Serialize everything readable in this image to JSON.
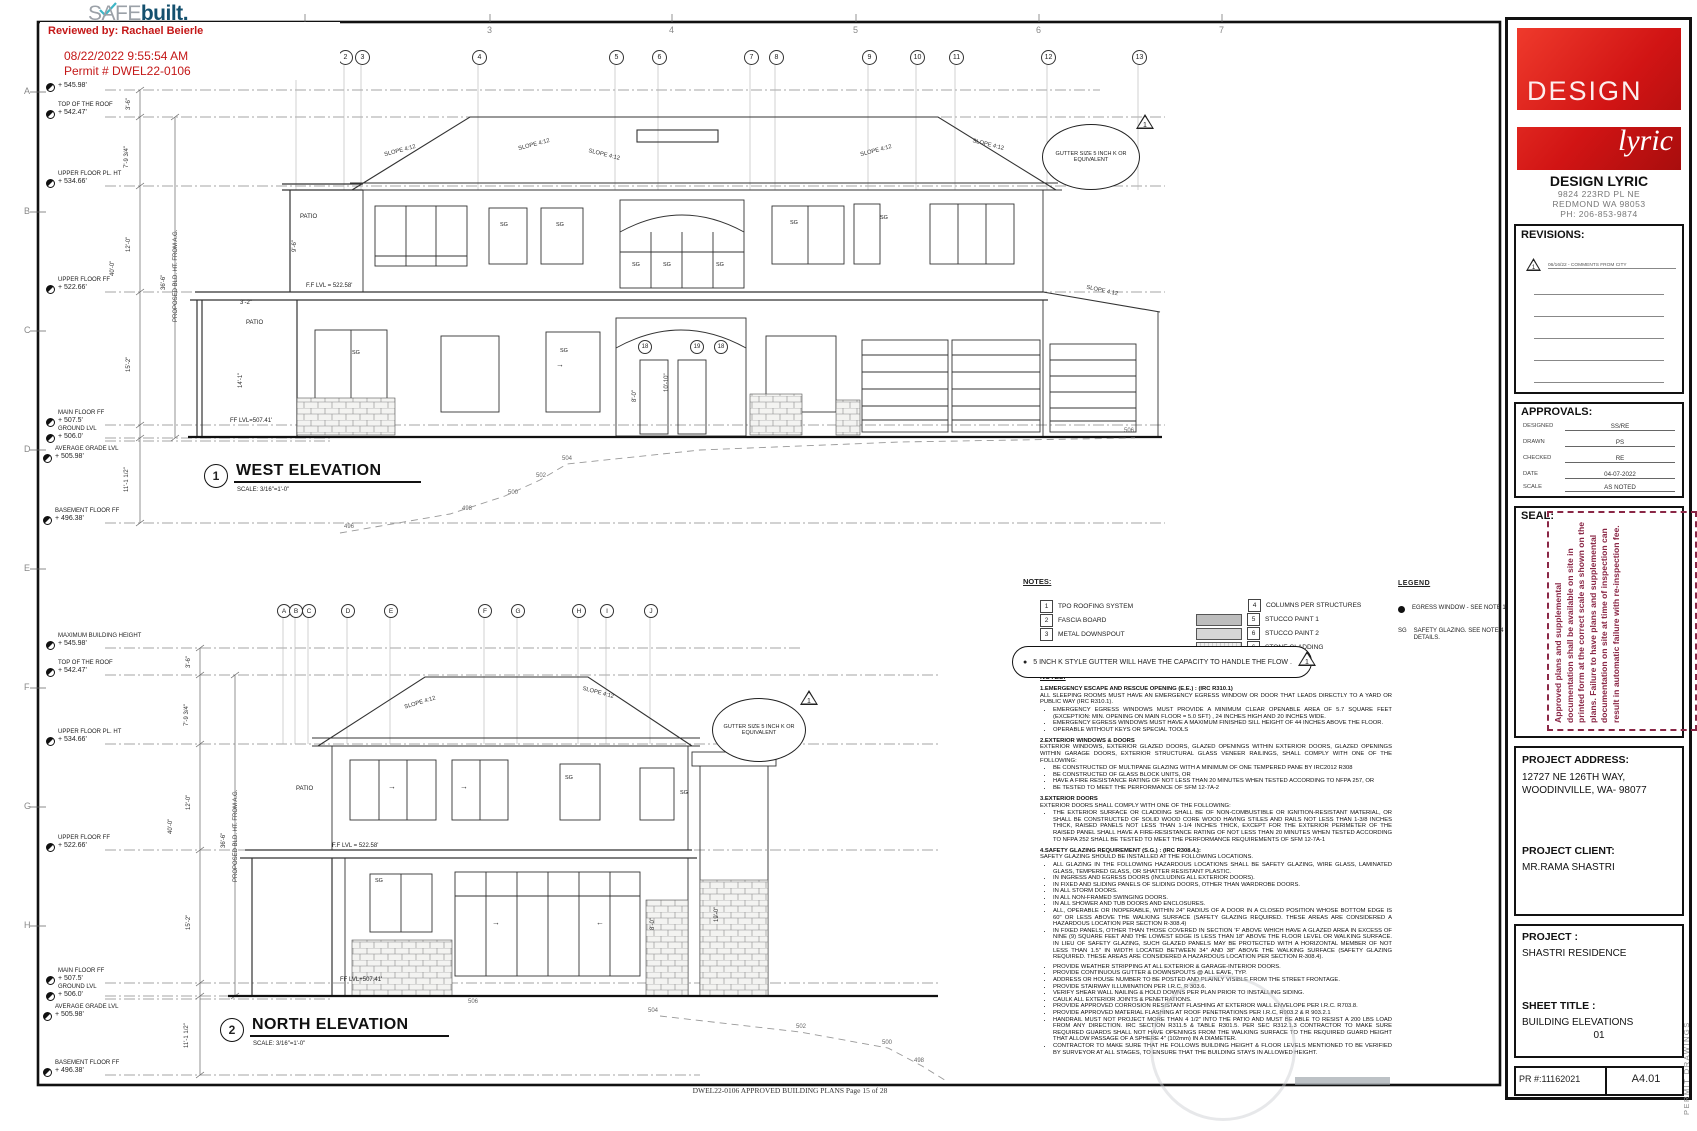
{
  "sym": {
    "slope": "SLOPE 4:12",
    "sg": "SG",
    "bullet": "●",
    "arrow_r": "→",
    "arrow_l": "←"
  },
  "safebuilt": {
    "safe": "SAFE",
    "built": "built",
    "dot": "."
  },
  "review_stamp": {
    "reviewed_by": "Reviewed by: Rachael Beierle",
    "datetime": "08/22/2022 9:55:54 AM",
    "permit": "Permit # DWEL22-0106"
  },
  "grid": {
    "top": [
      "2",
      "3",
      "4",
      "5",
      "6",
      "7"
    ],
    "left": [
      "A",
      "B",
      "C",
      "D",
      "E",
      "F",
      "G",
      "H"
    ]
  },
  "levels": [
    {
      "label": "MAXIMUM BUILDING HEIGHT",
      "value": "+ 545.98'"
    },
    {
      "label": "TOP OF THE ROOF",
      "value": "+ 542.47'"
    },
    {
      "label": "UPPER FLOOR PL. HT",
      "value": "+ 534.66'"
    },
    {
      "label": "UPPER FLOOR FF",
      "value": "+ 522.66'"
    },
    {
      "label": "MAIN FLOOR FF",
      "value": "+ 507.5'"
    },
    {
      "label": "GROUND LVL",
      "value": "+ 506.0'"
    },
    {
      "label": "AVERAGE GRADE LVL",
      "value": "+ 505.98'"
    },
    {
      "label": "BASEMENT FLOOR FF",
      "value": "+ 496.38'"
    }
  ],
  "west": {
    "num": "1",
    "title": "WEST ELEVATION",
    "scale": "SCALE:   3/16\"=1'-0\"",
    "bubbles": [
      "1",
      "2",
      "3",
      "4",
      "5",
      "6",
      "7",
      "8",
      "9",
      "10",
      "11",
      "12",
      "13"
    ],
    "dims": [
      "3'-6\"",
      "7'-9 3/4\"",
      "12'-0\"",
      "15'-2\"",
      "11'-1 1/2\"",
      "40'-0\"",
      "36'-6\"",
      "PROPOSED BLD. HT. FROM A.G.",
      "14'-1\""
    ],
    "house_dims": [
      "10'-10\"",
      "8'-0\"",
      "3'-2\"",
      "9'-6\""
    ],
    "ann": {
      "patio": "PATIO",
      "ff_upper": "F.F LVL = 522.58'",
      "ff_main": "FF LVL=507.41'"
    },
    "win_bubbles": [
      "18",
      "19",
      "18"
    ],
    "contours": [
      "496",
      "498",
      "500",
      "502",
      "504",
      "506"
    ],
    "gutter_note": "GUTTER SIZE 5 INCH K OR EQUIVALENT",
    "gutter_tri": "1"
  },
  "north": {
    "num": "2",
    "title": "NORTH ELEVATION",
    "scale": "SCALE:   3/16\"=1'-0\"",
    "bubbles": [
      "A",
      "B",
      "C",
      "D",
      "E",
      "F",
      "G",
      "H",
      "I",
      "J"
    ],
    "dims": [
      "3'-6\"",
      "7'-9 3/4\"",
      "12'-0\"",
      "15'-2\"",
      "11'-1 1/2\"",
      "40'-0\"",
      "36'-6\"",
      "PROPOSED BLD. HT. FROM A.G.",
      "19'-0\"",
      "8'-0\""
    ],
    "ann": {
      "patio": "PATIO",
      "ff_upper": "F.F LVL = 522.58'",
      "ff_main": "FF LVL+507.41'"
    },
    "contours": [
      "504",
      "502",
      "500",
      "498",
      "506"
    ],
    "gutter_note": "GUTTER SIZE 5 INCH K OR EQUIVALENT",
    "gutter_tri": "1"
  },
  "notes_key": {
    "title": "NOTES:",
    "items": [
      {
        "num": "1",
        "text": "TPO ROOFING SYSTEM"
      },
      {
        "num": "2",
        "text": "FASCIA BOARD"
      },
      {
        "num": "3",
        "text": "METAL DOWNSPOUT"
      },
      {
        "num": "4",
        "text": "COLUMNS PER STRUCTURES"
      },
      {
        "num": "5",
        "text": "STUCCO PAINT 1"
      },
      {
        "num": "6",
        "text": "STUCCO PAINT 2"
      },
      {
        "num": "6",
        "text": "STONE CLADDING"
      }
    ]
  },
  "legend": {
    "title": "LEGEND",
    "egress_text": "EGRESS WINDOW - SEE NOTE 1.",
    "sg_sym": "SG",
    "sg_text": "SAFETY GLAZING. SEE NOTE 4 FOR DETAILS."
  },
  "cloud_note": {
    "text": "5 INCH K STYLE GUTTER WILL HAVE THE CAPACITY TO HANDLE THE FLOW .",
    "tri": "1"
  },
  "notes": {
    "title": "NOTES:",
    "s1": {
      "h": "1.EMERGENCY ESCAPE AND RESCUE OPENING (E.E.) : (IRC R310.1)",
      "b": "ALL SLEEPING ROOMS MUST HAVE AN EMERGENCY EGRESS WINDOW OR DOOR THAT LEADS DIRECTLY TO A YARD OR PUBLIC WAY (IRC R310.1).",
      "li": [
        "EMERGENCY EGRESS WINDOWS MUST PROVIDE A MINIMUM CLEAR OPENABLE AREA OF 5.7 SQUARE FEET (EXCEPTION:  MIN. OPENING ON MAIN FLOOR = 5.0 SFT) , 24 INCHES HIGH AND 20 INCHES WIDE.",
        "EMERGENCY EGRESS WINDOWS MUST HAVE A MAXIMUM FINISHED SILL HEIGHT OF 44 INCHES ABOVE THE FLOOR.",
        "OPERABLE WITHOUT KEYS OR SPECIAL TOOLS"
      ]
    },
    "s2": {
      "h": "2.EXTERIOR WINDOWS & DOORS",
      "b": "EXTERIOR WINDOWS, EXTERIOR GLAZED DOORS, GLAZED OPENINGS WITHIN EXTERIOR DOORS, GLAZED OPENINGS WITHIN GARAGE DOORS, EXTERIOR STRUCTURAL GLASS VENEER RAILINGS, SHALL COMPLY WITH ONE OF THE FOLLOWING:",
      "li": [
        "BE CONSTRUCTED OF MULTIPANE GLAZING WITH A MINIMUM OF ONE TEMPERED PANE BY IRC2012 R308",
        "BE CONSTRUCTED OF GLASS BLOCK UNITS, OR",
        "HAVE A FIRE RESISTANCE RATING OF NOT LESS THAN 20 MINUTES WHEN TESTED ACCORDING TO NFPA 257, OR",
        "BE TESTED TO MEET THE PERFORMANCE OF SFM 12-7A-2"
      ]
    },
    "s3": {
      "h": "3.EXTERIOR DOORS",
      "b": "EXTERIOR DOORS SHALL COMPLY WITH ONE OF THE FOLLOWING:",
      "li": [
        "THE EXTERIOR SURFACE OR CLADDING SHALL BE OF NON-COMBUSTIBLE OR IGNITION-RESISTANT MATERIAL, OR SHALL BE CONSTRUCTED OF SOLID WOOD CORE WOOD HAVING STILES AND RAILS NOT LESS THAN 1-3/8 INCHES THICK, RAISED PANELS NOT LESS THAN 1-1/4 INCHES THICK, EXCEPT FOR THE EXTERIOR PERIMETER OF THE RAISED PANEL SHALL HAVE A FIRE-RESISTANCE RATING OF NOT LESS THAN 20 MINUTES WHEN TESTED ACCORDING TO NFPA 252 SHALL BE TESTED TO MEET THE PERFORMANCE REQUIREMENTS OF SFM 12-7A-1"
      ]
    },
    "s4": {
      "h": "4.SAFETY GLAZING REQUIREMENT (S.G.) : (IRC R308.4.):",
      "b": "SAFETY GLAZING SHOULD BE INSTALLED AT THE FOLLOWING LOCATIONS.",
      "li": [
        "ALL GLAZING IN THE FOLLOWING HAZARDOUS LOCATIONS SHALL BE SAFETY GLAZING, WIRE GLASS, LAMINATED GLASS, TEMPERED GLASS, OR SHATTER RESISTANT PLASTIC.",
        "IN INGRESS AND EGRESS DOORS (INCLUDING ALL EXTERIOR DOORS).",
        "IN FIXED AND SLIDING PANELS OF SLIDING DOORS, OTHER THAN WARDROBE DOORS.",
        "IN ALL STORM DOORS.",
        "IN ALL NON-FRAMED SWINGING DOORS.",
        "IN ALL SHOWER AND TUB DOORS AND ENCLOSURES.",
        "ALL, OPERABLE OR INOPERABLE, WITHIN 24\" RADIUS OF A DOOR IN A CLOSED POSITION WHOSE BOTTOM EDGE IS 60\" OR LESS ABOVE THE WALKING SURFACE (SAFETY GLAZING REQUIRED. THESE AREAS ARE CONSIDERED A HAZARDOUS LOCATION PER SECTION R-308.4)",
        "IN FIXED PANELS, OTHER THAN THOSE COVERED IN SECTION 'F' ABOVE WHICH HAVE A GLAZED AREA IN EXCESS OF NINE (9) SQUARE FEET AND THE LOWEST EDGE IS LESS THAN 18\" ABOVE THE FLOOR LEVEL OR WALKING SURFACE.  IN LIEU OF SAFETY GLAZING, SUCH GLAZED PANELS MAY BE PROTECTED WITH A HORIZONTAL MEMBER OF NOT LESS THAN 1.5\" IN WIDTH LOCATED BETWEEN 34\" AND 38\" ABOVE THE WALKING SURFACE (SAFETY GLAZING REQUIRED. THESE AREAS ARE CONSIDERED A HAZARDOUS LOCATION PER SECTION R-308.4)."
      ]
    },
    "general": [
      "PROVIDE WEATHER STRIPPING AT ALL EXTERIOR & GARAGE-INTERIOR DOORS.",
      "PROVIDE CONTINUOUS GUTTER & DOWNSPOUTS @ ALL EAVE, TYP.",
      "ADDRESS OR HOUSE NUMBER TO BE POSTED AND PLAINLY VISIBLE FROM THE STREET FRONTAGE.",
      "PROVIDE STAIRWAY ILLUMINATION PER I.R.C. R 303.6.",
      "VERIFY SHEAR WALL NAILING & HOLD DOWNS PER PLAN PRIOR TO INSTALLING SIDING.",
      "CAULK ALL EXTERIOR JOINTS & PENETRATIONS.",
      "PROVIDE APPROVED CORROSION RESISTANT FLASHING AT EXTERIOR WALL ENVELOPE PER I.R.C. R703.8.",
      "PROVIDE APPROVED MATERIAL FLASHING AT ROOF PENETRATIONS PER I.R.C, R903.2 & R 903.2.1",
      "HANDRAIL MUST NOT PROJECT MORE THAN 4 1/2\" INTO THE PATIO AND MUST BE ABLE TO RESIST A 200 LBS LOAD FROM ANY DIRECTION. IRC SECTION R311.5 & TABLE R301.5. PER SEC R312.1.3 CONTRACTOR TO MAKE SURE REQUIRED GUARDS SHALL NOT HAVE OPENINGS FROM THE WALKING SURFACE TO THE REQUIRED GUARD HEIGHT THAT ALLOW PASSAGE OF A SPHERE 4\" (102mm) IN A DIAMETER.",
      "CONTRACTOR TO MAKE SURE THAT HE FOLLOWS BUILDING HEIGHT & FLOOR LEVELS MENTIONED TO BE VERIFIED BY SURVEYOR AT ALL STAGES, TO ENSURE THAT THE BUILDING STAYS IN ALLOWED HEIGHT."
    ]
  },
  "titleblock": {
    "firm": {
      "logo_line1": "DESIGN",
      "logo_line2": "lyric",
      "name": "DESIGN LYRIC",
      "addr1": "9824 223RD PL NE",
      "addr2": "REDMOND WA 98053",
      "phone": "PH: 206-853-9874"
    },
    "revisions": {
      "title": "REVISIONS:",
      "entry_tri": "1",
      "entry": "06/16/22  -  COMMENTS FROM CITY"
    },
    "approvals": {
      "title": "APPROVALS:",
      "rows": [
        {
          "label": "DESIGNED",
          "value": "SS/RE"
        },
        {
          "label": "DRAWN",
          "value": "PS"
        },
        {
          "label": "CHECKED",
          "value": "RE"
        },
        {
          "label": "DATE",
          "value": "04-07-2022"
        },
        {
          "label": "SCALE",
          "value": "AS NOTED"
        }
      ]
    },
    "seal": {
      "title": "SEAL:",
      "stamp": "Approved plans and supplemental documentation shall be available on site in printed form at the correct scale as shown on the plans. Failure to have plans and supplemental documentation on site at time of inspection can result in automatic failure with re-inspection fee."
    },
    "address": {
      "title": "PROJECT ADDRESS:",
      "line1": "12727 NE 126TH WAY,",
      "line2": "WOODINVILLE, WA- 98077"
    },
    "client": {
      "title": "PROJECT CLIENT:",
      "name": "MR.RAMA SHASTRI"
    },
    "project": {
      "title": "PROJECT :",
      "name": "SHASTRI RESIDENCE"
    },
    "sheet": {
      "title": "SHEET TITLE :",
      "name": "BUILDING ELEVATIONS",
      "num": "01"
    },
    "pr": {
      "label": "PR #:11162021",
      "sheet_no": "A4.01"
    }
  },
  "footer": "DWEL22-0106 APPROVED BUILDING PLANS Page 15 of 28",
  "side_text": "PERMIT  DRAWINGS"
}
